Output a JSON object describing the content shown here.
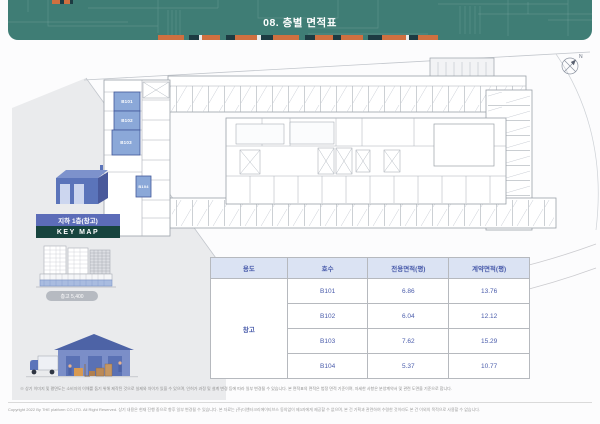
{
  "header": {
    "title": "08. 층별 면적표"
  },
  "keymap": {
    "floor_label": "지하 1층(창고)",
    "title": "KEY MAP"
  },
  "plan": {
    "units": [
      {
        "id": "B101"
      },
      {
        "id": "B102"
      },
      {
        "id": "B103"
      },
      {
        "id": "B104"
      }
    ],
    "compass_label": "N"
  },
  "elevation": {
    "caption": "층고 5,400"
  },
  "table": {
    "headers": [
      "용도",
      "호수",
      "전용면적(평)",
      "계약면적(평)"
    ],
    "usage_label": "창고",
    "rows": [
      {
        "unit": "B101",
        "exclusive_area": "6.86",
        "contract_area": "13.76"
      },
      {
        "unit": "B102",
        "exclusive_area": "6.04",
        "contract_area": "12.12"
      },
      {
        "unit": "B103",
        "exclusive_area": "7.62",
        "contract_area": "15.29"
      },
      {
        "unit": "B104",
        "exclusive_area": "5.37",
        "contract_area": "10.77"
      }
    ]
  },
  "footer": {
    "note": "※ 상기 이미지 및 평면도는 소비자의 이해를 돕기 위해 제작된 것으로 실제와 차이가 있을 수 있으며, 인허가 과정 및 설계 변경 등에 따라 일부 변경될 수 있습니다. 본 면적표의 면적은 법정 면적 기준이며, 자세한 사항은 분양계약서 및 관련 도면을 기준으로 합니다.",
    "copyright": "Copyright 2022 By THE platform CO.LTD. All Right Reserved. 상기 내용은 현재 진행 중으로 향후 일부 변경될 수 있습니다. 본 자료는 (주)더앤터크리에이티브스 동의없이 제3자에게 제공할 수 없으며, 본 건 기획과 관련하여 수령한 것이라도 본 건 이외의 목적으로 사용할 수 없습니다."
  },
  "colors": {
    "header_teal": "#3f7d75",
    "accent_orange": "#cf7040",
    "accent_dark": "#1d3b42",
    "keymap_blue": "#5c6cb8",
    "keymap_dark_teal": "#17443e",
    "unit_fill_blue": "#8ba8d8",
    "table_text_blue": "#4a5cab",
    "table_header_bg": "#dbe3f3"
  }
}
